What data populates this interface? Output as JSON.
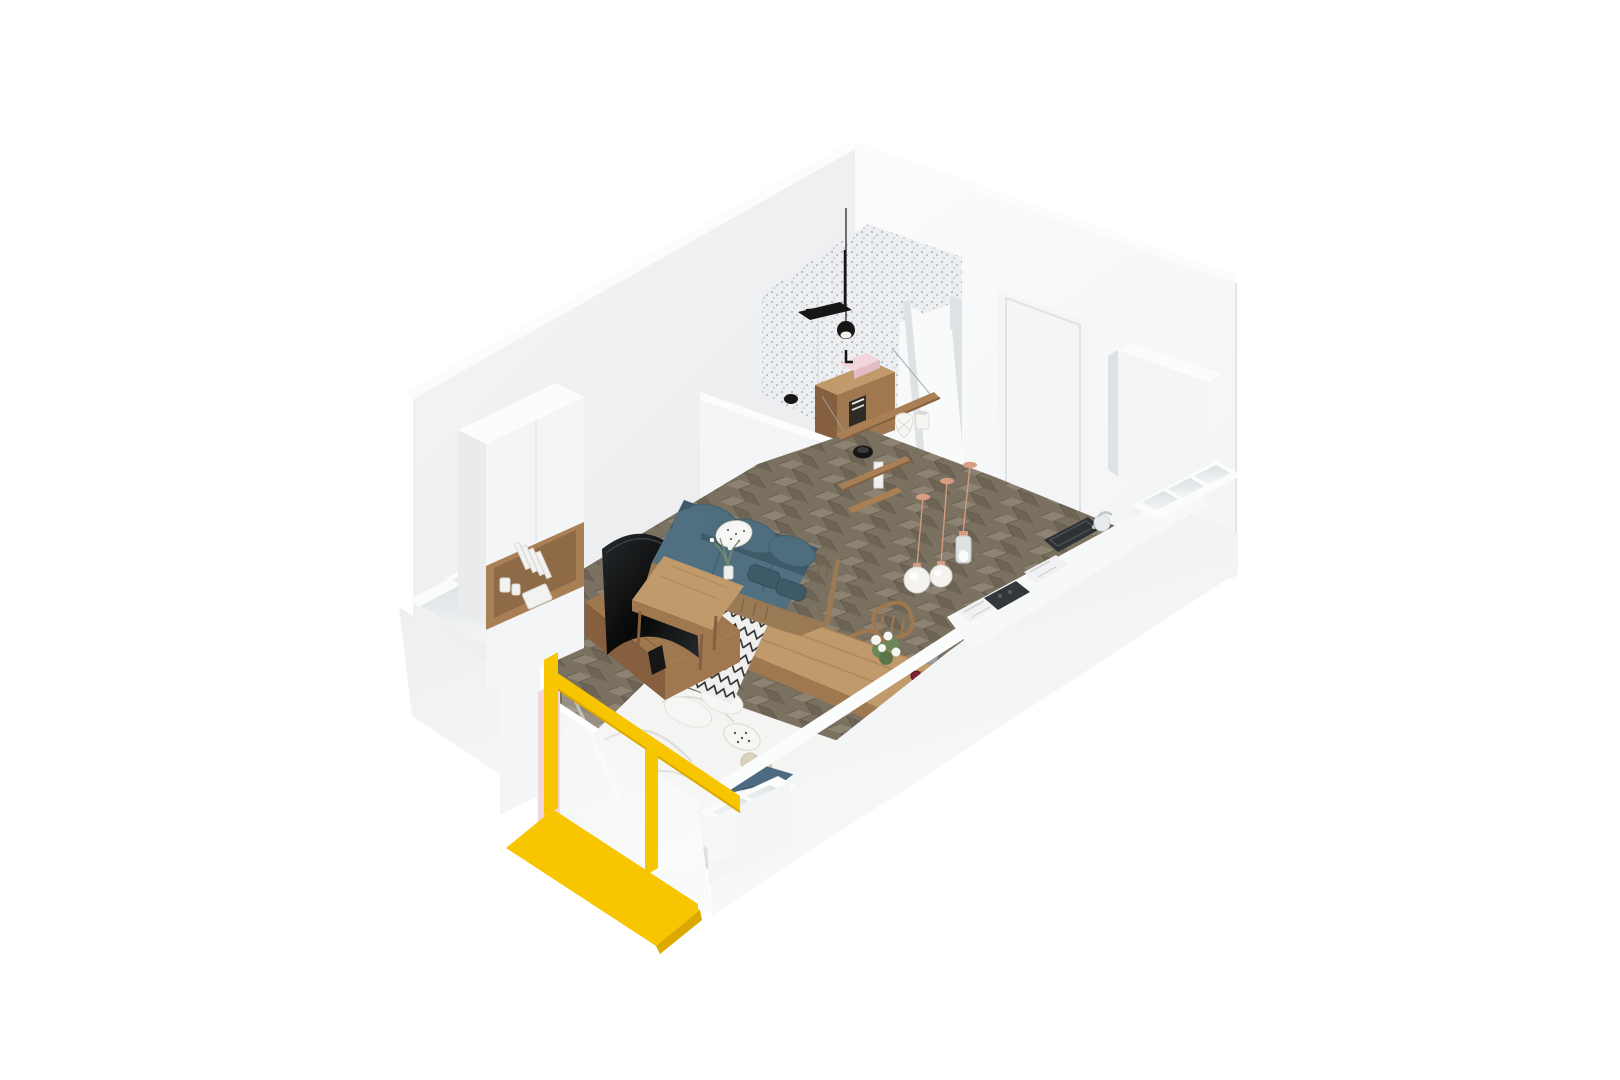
{
  "meta": {
    "title": "Isometric 3D cutaway render of a studio apartment",
    "view": "axonometric top-down, walls cut at mid height",
    "rooms": [
      {
        "name": "living-sleeping-area",
        "floor": "dark herringbone parquet",
        "contents": [
          "teal rattan sofa",
          "curved TV on wood console",
          "zigzag rug",
          "double bed",
          "wardrobe with wood niche"
        ]
      },
      {
        "name": "bathroom",
        "contents": [
          "mosaic tile wall",
          "black shower set",
          "black pendant lamp",
          "wood vanity with pink vessel sink",
          "open white door"
        ]
      },
      {
        "name": "kitchen-dining",
        "contents": [
          "white counter with marble inserts",
          "dark cooktop",
          "dark sink basin",
          "round faucet",
          "wood dining table",
          "two spindle chairs",
          "white flower bouquet",
          "serving tray with teapot and red drinks",
          "three copper-cord pendant lamps"
        ]
      },
      {
        "name": "balcony-edge",
        "contents": [
          "yellow glass partition",
          "yellow painted floor",
          "pink accent wall strip",
          "cut parapet storage boxes"
        ]
      }
    ]
  },
  "palette": {
    "background": "#ffffff",
    "wall_light": "#f4f5f6",
    "wall_mid": "#e9ebed",
    "wall_dark": "#dfe2e4",
    "wall_top": "#fbfcfc",
    "outer_light": "#f9fafa",
    "outer_mid": "#edeff0",
    "floor_base": "#7b7161",
    "floor_plank_light": "#8d8372",
    "floor_plank_dark": "#6e6455",
    "floor_line": "#5e5649",
    "mosaic_bg": "#edeef0",
    "mosaic_dot": "#9ba3b0",
    "tile_bg": "#e2e4e6",
    "tile_dot": "#aeb4ba",
    "wood_light": "#c09a6a",
    "wood_mid": "#a07850",
    "wood_dark": "#86603e",
    "shelf_wood": "#a97f55",
    "sofa_teal": "#507082",
    "sofa_teal_dark": "#3e5a69",
    "sofa_cushion": "#4e6d7d",
    "rattan": "#9a7a55",
    "rattan_dark": "#7d6242",
    "rug_bg": "#eff0ee",
    "rug_line": "#2c2b29",
    "tv_dark": "#070808",
    "tv_light": "#26292c",
    "duvet": "#f4f4f2",
    "duvet_shadow": "#d9dad8",
    "pillow_white": "#f6f6f4",
    "pillow_beige": "#d9d2bd",
    "throw_blue": "#4d6a83",
    "throw_blue_dark": "#3c5670",
    "yellow": "#f7c600",
    "yellow_dark": "#dca900",
    "pink": "#f2d6dc",
    "counter": "#f7f8f8",
    "marble": "#f0f1f2",
    "marble_vein": "#c6c9cd",
    "cooktop": "#33383c",
    "basin": "#2e3236",
    "copper": "#d99b82",
    "lamp_white": "#f4f2ef",
    "lamp_glass": "#e9ecee",
    "plant_green": "#6d8758",
    "flower_white": "#f5f6f2",
    "drink_red": "#7e2433",
    "black": "#161616",
    "book_white": "#f2f2f0",
    "cavity": "#dde1e4"
  }
}
